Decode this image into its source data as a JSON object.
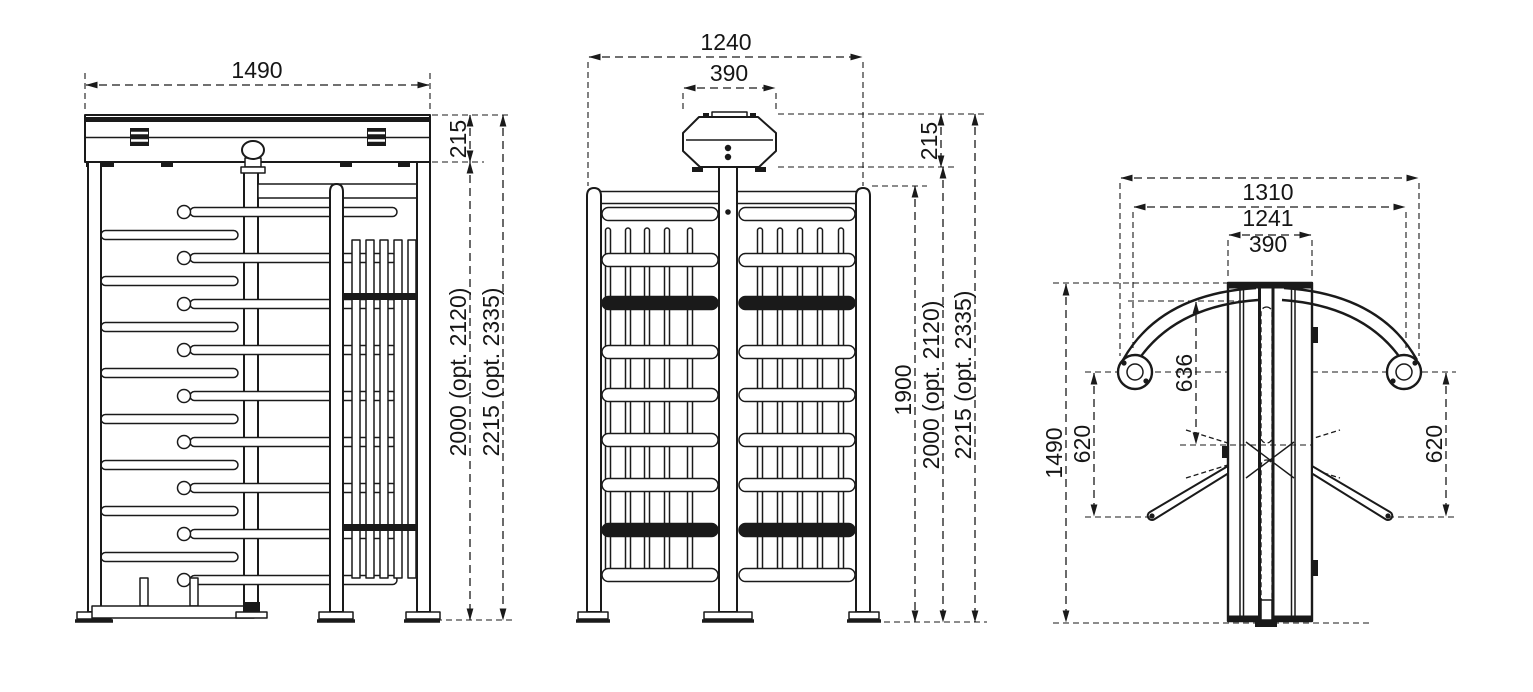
{
  "views": {
    "front": {
      "dims": {
        "width": "1490",
        "header_height": "215",
        "height": "2000 (opt. 2120)",
        "total_height": "2215 (opt. 2335)"
      }
    },
    "side": {
      "dims": {
        "width": "1240",
        "head_width": "390",
        "head_height": "215",
        "frame_height": "1900",
        "height": "2000 (opt. 2120)",
        "total_height": "2215 (opt. 2335)"
      }
    },
    "plan": {
      "dims": {
        "overall_width": "1310",
        "post_spacing": "1241",
        "column_width": "390",
        "depth": "1490",
        "left_clearance": "620",
        "rotor_offset": "636",
        "right_clearance": "620"
      }
    }
  },
  "colors": {
    "line": "#1a1a1a",
    "background": "#ffffff"
  }
}
